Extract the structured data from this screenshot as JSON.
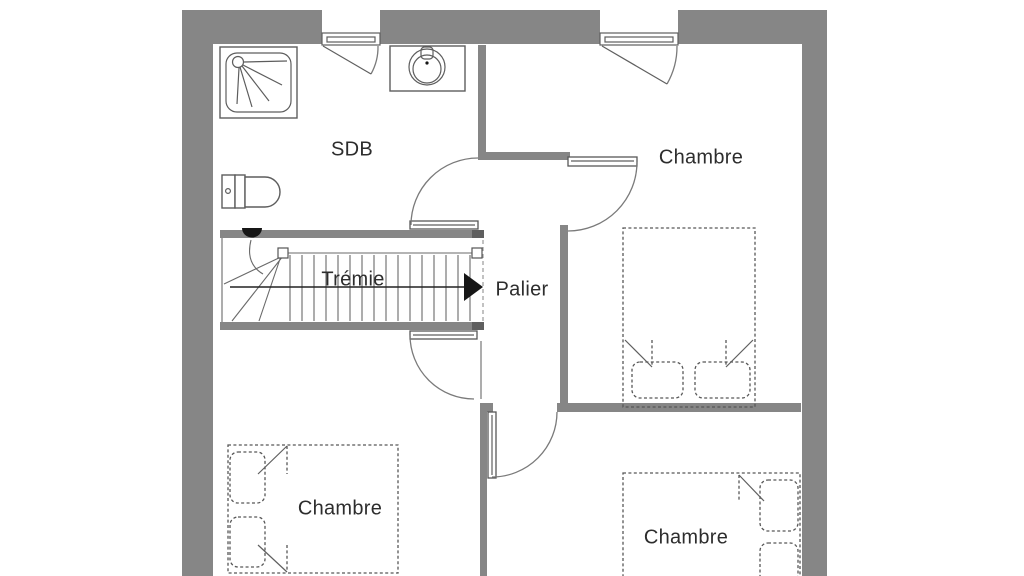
{
  "plan": {
    "title": "Floor plan – upper storey",
    "rooms": {
      "sdb": {
        "label": "SDB"
      },
      "chambre_top_right": {
        "label": "Chambre"
      },
      "tremie": {
        "label": "Trémie"
      },
      "palier": {
        "label": "Palier"
      },
      "chambre_bottom_left": {
        "label": "Chambre"
      },
      "chambre_bottom_right": {
        "label": "Chambre"
      }
    },
    "fixtures": {
      "shower": "shower-tray",
      "sink": "washbasin",
      "toilet": "toilet",
      "stairs": "staircase-with-direction-arrow",
      "beds": "double-bed-dashed"
    },
    "colors": {
      "wall": "#868686",
      "wall_cap": "#5f5f5f",
      "line": "#6a6a6a",
      "furniture_line": "#5d5d5d",
      "text": "#2d2d2d",
      "background": "#ffffff"
    }
  }
}
